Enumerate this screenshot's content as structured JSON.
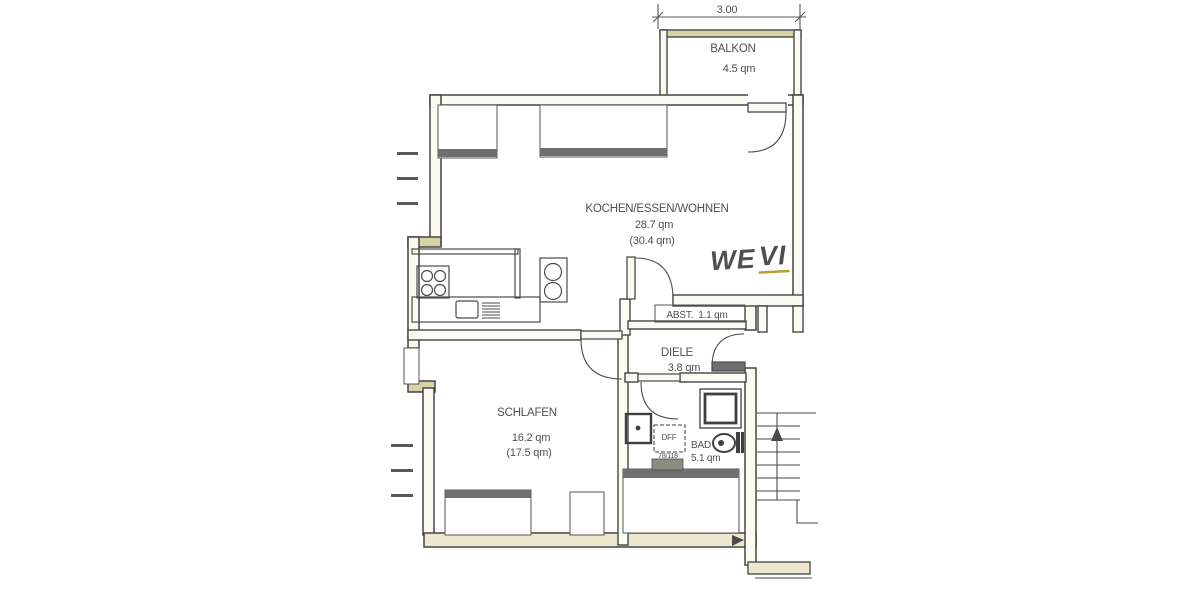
{
  "plan_title": "Apartment floor plan WE VI",
  "dimension": {
    "top_width": "3.00"
  },
  "annotations": {
    "unit_prefix": "WE",
    "unit_number": "VI",
    "skylight_label": "DFF",
    "skylight_size": "78/118"
  },
  "rooms": {
    "balkon": {
      "name": "BALKON",
      "area": "4.5 qm"
    },
    "wohnen": {
      "name": "KOCHEN/ESSEN/WOHNEN",
      "area": "28.7 qm",
      "area_alt": "(30.4 qm)"
    },
    "abst": {
      "name": "ABST.",
      "area": "1.1 qm"
    },
    "diele": {
      "name": "DIELE",
      "area": "3.8 qm"
    },
    "schlafen": {
      "name": "SCHLAFEN",
      "area": "16.2 qm",
      "area_alt": "(17.5 qm)"
    },
    "bad": {
      "name": "BAD",
      "area": "5.1 qm"
    }
  },
  "fixtures": [
    "stove",
    "kitchen-sink",
    "drainer",
    "hob-unit",
    "washbasin",
    "skylight",
    "toilet",
    "shower",
    "radiator",
    "staircase"
  ],
  "colors": {
    "line": "#4a4a4a",
    "wall_fill": "#fbfaf3",
    "wall_tint": "#d9d2a6",
    "bottom_wall_tint": "#ece7cd",
    "window_band": "#6f6f6f",
    "text": "#4f4f4f",
    "annotation": "#b3a232",
    "paper": "#ffffff"
  }
}
